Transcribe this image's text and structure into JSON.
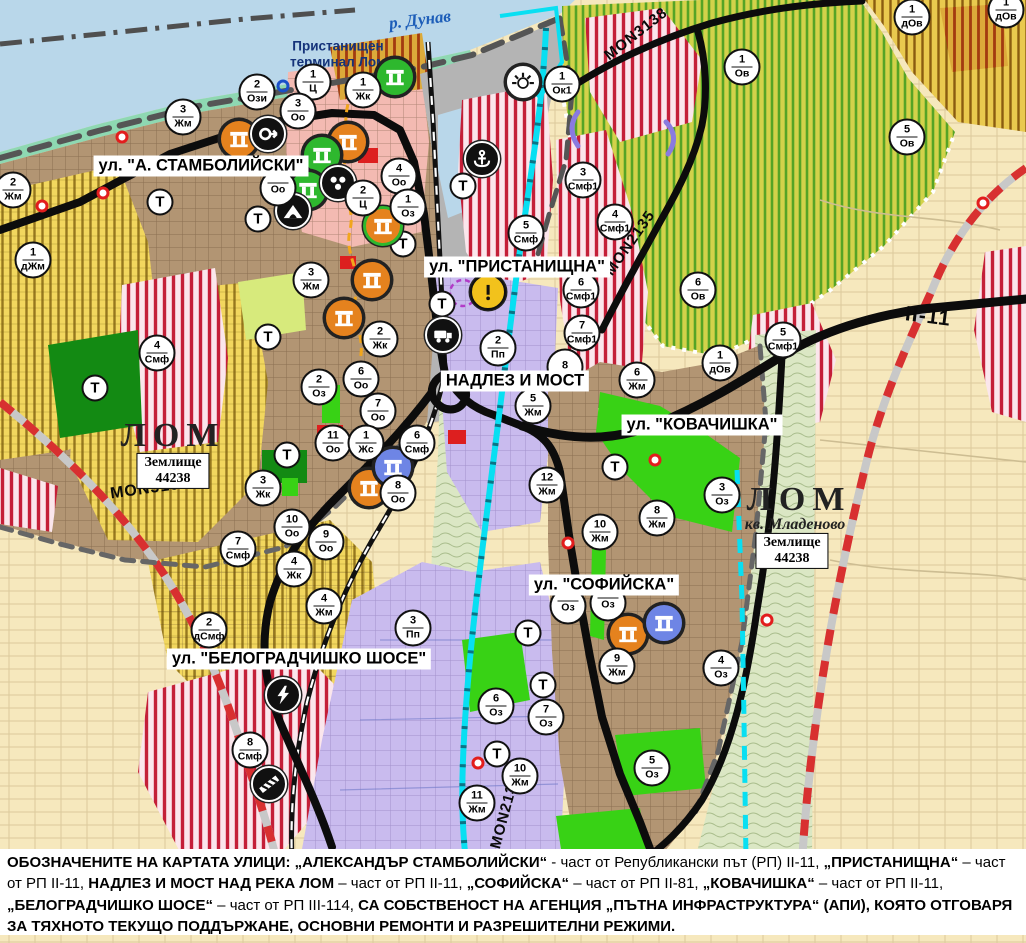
{
  "river": {
    "label": "р. Дунав",
    "x": 420,
    "y": 20
  },
  "port": {
    "line1": "Пристанищен",
    "line2": "терминал Лом",
    "x": 338,
    "y": 54
  },
  "places": {
    "lom_west": {
      "label": "ЛОМ",
      "x": 173,
      "y": 436
    },
    "lom_east": {
      "label": "ЛОМ",
      "x": 799,
      "y": 500
    },
    "kv_mladenovo": {
      "label": "кв. Младеново",
      "x": 795,
      "y": 525
    },
    "zem_west": {
      "line1": "Землище",
      "line2": "44238",
      "x": 173,
      "y": 471
    },
    "zem_east": {
      "line1": "Землище",
      "line2": "44238",
      "x": 792,
      "y": 551
    }
  },
  "street_labels": [
    {
      "text": "ул. \"А. СТАМБОЛИЙСКИ\"",
      "x": 201,
      "y": 166
    },
    {
      "text": "ул. \"ПРИСТАНИЩНА\"",
      "x": 517,
      "y": 267
    },
    {
      "text": "НАДЛЕЗ И МОСТ",
      "x": 515,
      "y": 381
    },
    {
      "text": "ул. \"КОВАЧИШКА\"",
      "x": 702,
      "y": 425
    },
    {
      "text": "ул. \"СОФИЙСКА\"",
      "x": 604,
      "y": 585
    },
    {
      "text": "ул. \"БЕЛОГРАДЧИШКО ШОСЕ\"",
      "x": 299,
      "y": 659
    }
  ],
  "road_labels": [
    {
      "text": "MON3138",
      "x": 636,
      "y": 34,
      "rot": -38,
      "size": 15
    },
    {
      "text": "MON2135",
      "x": 630,
      "y": 243,
      "rot": -55,
      "size": 15
    },
    {
      "text": "MON3139",
      "x": 150,
      "y": 489,
      "rot": -8,
      "size": 16
    },
    {
      "text": "MON2136",
      "x": 505,
      "y": 812,
      "rot": -75,
      "size": 15
    },
    {
      "text": "II-11",
      "x": 928,
      "y": 317,
      "rot": 7,
      "size": 21
    }
  ],
  "zone_markers": [
    {
      "n": "2",
      "c": "Жм",
      "x": 13,
      "y": 190
    },
    {
      "n": "3",
      "c": "Жм",
      "x": 183,
      "y": 117
    },
    {
      "n": "2",
      "c": "Ози",
      "x": 257,
      "y": 92
    },
    {
      "n": "1",
      "c": "Ц",
      "x": 313,
      "y": 82
    },
    {
      "n": "1",
      "c": "Жк",
      "x": 363,
      "y": 90
    },
    {
      "n": "3",
      "c": "Оо",
      "x": 298,
      "y": 111
    },
    {
      "n": "4",
      "c": "Оо",
      "x": 399,
      "y": 176
    },
    {
      "n": "2",
      "c": "Ц",
      "x": 363,
      "y": 198
    },
    {
      "n": "1",
      "c": "Оз",
      "x": 408,
      "y": 207
    },
    {
      "n": "",
      "c": "Оо",
      "x": 278,
      "y": 188
    },
    {
      "n": "1",
      "c": "дЖм",
      "x": 33,
      "y": 260
    },
    {
      "n": "3",
      "c": "Жм",
      "x": 311,
      "y": 280
    },
    {
      "n": "2",
      "c": "Жк",
      "x": 380,
      "y": 339
    },
    {
      "n": "2",
      "c": "Оз",
      "x": 319,
      "y": 387
    },
    {
      "n": "6",
      "c": "Оо",
      "x": 361,
      "y": 379
    },
    {
      "n": "7",
      "c": "Оо",
      "x": 378,
      "y": 411
    },
    {
      "n": "11",
      "c": "Оо",
      "x": 333,
      "y": 443
    },
    {
      "n": "1",
      "c": "Жс",
      "x": 366,
      "y": 443
    },
    {
      "n": "6",
      "c": "Смф",
      "x": 417,
      "y": 443
    },
    {
      "n": "8",
      "c": "Оо",
      "x": 398,
      "y": 493
    },
    {
      "n": "3",
      "c": "Жк",
      "x": 263,
      "y": 488
    },
    {
      "n": "10",
      "c": "Оо",
      "x": 292,
      "y": 527
    },
    {
      "n": "9",
      "c": "Оо",
      "x": 326,
      "y": 542
    },
    {
      "n": "7",
      "c": "Смф",
      "x": 238,
      "y": 549
    },
    {
      "n": "4",
      "c": "Жк",
      "x": 294,
      "y": 569
    },
    {
      "n": "4",
      "c": "Жм",
      "x": 324,
      "y": 606
    },
    {
      "n": "2",
      "c": "дСмф",
      "x": 209,
      "y": 630
    },
    {
      "n": "4",
      "c": "Смф",
      "x": 157,
      "y": 353
    },
    {
      "n": "8",
      "c": "Смф",
      "x": 250,
      "y": 750
    },
    {
      "n": "3",
      "c": "Пп",
      "x": 413,
      "y": 628
    },
    {
      "n": "2",
      "c": "Пп",
      "x": 498,
      "y": 348
    },
    {
      "n": "5",
      "c": "Смф",
      "x": 526,
      "y": 233
    },
    {
      "n": "3",
      "c": "Смф1",
      "x": 583,
      "y": 180
    },
    {
      "n": "4",
      "c": "Смф1",
      "x": 615,
      "y": 222
    },
    {
      "n": "6",
      "c": "Смф1",
      "x": 581,
      "y": 290
    },
    {
      "n": "7",
      "c": "Смф1",
      "x": 582,
      "y": 333
    },
    {
      "n": "8",
      "c": "",
      "x": 565,
      "y": 367
    },
    {
      "n": "5",
      "c": "Жм",
      "x": 533,
      "y": 406
    },
    {
      "n": "6",
      "c": "Жм",
      "x": 637,
      "y": 380
    },
    {
      "n": "12",
      "c": "Жм",
      "x": 547,
      "y": 485
    },
    {
      "n": "8",
      "c": "Жм",
      "x": 657,
      "y": 518
    },
    {
      "n": "10",
      "c": "Жм",
      "x": 600,
      "y": 532
    },
    {
      "n": "3",
      "c": "Оз",
      "x": 722,
      "y": 495
    },
    {
      "n": "9",
      "c": "Жм",
      "x": 617,
      "y": 666
    },
    {
      "n": "4",
      "c": "Оз",
      "x": 721,
      "y": 668
    },
    {
      "n": "6",
      "c": "Оз",
      "x": 496,
      "y": 706
    },
    {
      "n": "7",
      "c": "Оз",
      "x": 546,
      "y": 717
    },
    {
      "n": "10",
      "c": "Жм",
      "x": 520,
      "y": 776
    },
    {
      "n": "11",
      "c": "Жм",
      "x": 477,
      "y": 803
    },
    {
      "n": "5",
      "c": "Оз",
      "x": 652,
      "y": 768
    },
    {
      "n": "",
      "c": "Оз",
      "x": 568,
      "y": 606
    },
    {
      "n": "",
      "c": "Оз",
      "x": 608,
      "y": 603
    },
    {
      "n": "1",
      "c": "Ок1",
      "x": 562,
      "y": 84
    },
    {
      "n": "1",
      "c": "Ов",
      "x": 742,
      "y": 67
    },
    {
      "n": "5",
      "c": "Ов",
      "x": 907,
      "y": 137
    },
    {
      "n": "6",
      "c": "Ов",
      "x": 698,
      "y": 290
    },
    {
      "n": "1",
      "c": "дОв",
      "x": 720,
      "y": 363
    },
    {
      "n": "5",
      "c": "Смф1",
      "x": 783,
      "y": 340
    },
    {
      "n": "1",
      "c": "дОв",
      "x": 912,
      "y": 17
    },
    {
      "n": "1",
      "c": "дОв",
      "x": 1006,
      "y": 10
    }
  ],
  "t_markers": [
    {
      "x": 160,
      "y": 202
    },
    {
      "x": 258,
      "y": 219
    },
    {
      "x": 403,
      "y": 244
    },
    {
      "x": 442,
      "y": 304
    },
    {
      "x": 268,
      "y": 337
    },
    {
      "x": 95,
      "y": 388
    },
    {
      "x": 287,
      "y": 455
    },
    {
      "x": 615,
      "y": 467
    },
    {
      "x": 528,
      "y": 633
    },
    {
      "x": 543,
      "y": 685
    },
    {
      "x": 497,
      "y": 754
    },
    {
      "x": 463,
      "y": 186
    }
  ],
  "icon_markers": [
    {
      "type": "monument",
      "fill": "#e5821e",
      "ring": "#222",
      "x": 239,
      "y": 139
    },
    {
      "type": "monument",
      "fill": "#e5821e",
      "ring": "#222",
      "x": 348,
      "y": 142
    },
    {
      "type": "monument",
      "fill": "#e5821e",
      "ring": "#222",
      "x": 372,
      "y": 280
    },
    {
      "type": "monument",
      "fill": "#e5821e",
      "ring": "#222",
      "x": 344,
      "y": 318
    },
    {
      "type": "monument",
      "fill": "#e5821e",
      "ring": "#222",
      "x": 369,
      "y": 488
    },
    {
      "type": "monument",
      "fill": "#e5821e",
      "ring": "#222",
      "x": 628,
      "y": 634
    },
    {
      "type": "monument",
      "fill": "#e5821e",
      "ring": "#2eb82e",
      "x": 383,
      "y": 226
    },
    {
      "type": "monument",
      "fill": "#2eb82e",
      "ring": "#222",
      "x": 395,
      "y": 77
    },
    {
      "type": "monument",
      "fill": "#2eb82e",
      "ring": "#222",
      "x": 322,
      "y": 155
    },
    {
      "type": "monument",
      "fill": "#2eb82e",
      "ring": "#222",
      "x": 308,
      "y": 190
    },
    {
      "type": "monument",
      "fill": "#6e85e5",
      "ring": "#222",
      "x": 393,
      "y": 467
    },
    {
      "type": "monument",
      "fill": "#6e85e5",
      "ring": "#222",
      "x": 664,
      "y": 623
    },
    {
      "type": "circle-arrow",
      "fill": "#111",
      "ring": "#fff",
      "x": 268,
      "y": 134
    },
    {
      "type": "group",
      "fill": "#111",
      "ring": "#fff",
      "x": 338,
      "y": 183
    },
    {
      "type": "cave",
      "fill": "#111",
      "ring": "#fff",
      "x": 293,
      "y": 211
    },
    {
      "type": "truck",
      "fill": "#111",
      "ring": "#fff",
      "x": 443,
      "y": 335
    },
    {
      "type": "anchor",
      "fill": "#111",
      "ring": "#fff",
      "x": 482,
      "y": 159
    },
    {
      "type": "lightning",
      "fill": "#111",
      "ring": "#fff",
      "x": 283,
      "y": 695
    },
    {
      "type": "barrier",
      "fill": "#111",
      "ring": "#fff",
      "x": 269,
      "y": 784
    },
    {
      "type": "sun",
      "fill": "#fff",
      "ring": "#222",
      "x": 523,
      "y": 82
    },
    {
      "type": "warning",
      "fill": "#f2c21c",
      "ring": "#111",
      "x": 488,
      "y": 292
    }
  ],
  "small_markers": [
    {
      "kind": "blue-ring",
      "x": 283,
      "y": 86
    },
    {
      "kind": "red-dot",
      "x": 122,
      "y": 137
    },
    {
      "kind": "red-dot",
      "x": 103,
      "y": 193
    },
    {
      "kind": "red-dot",
      "x": 42,
      "y": 206
    },
    {
      "kind": "red-dot",
      "x": 655,
      "y": 460
    },
    {
      "kind": "red-dot",
      "x": 568,
      "y": 543
    },
    {
      "kind": "red-dot",
      "x": 983,
      "y": 203
    },
    {
      "kind": "red-dot",
      "x": 478,
      "y": 763
    },
    {
      "kind": "red-dot",
      "x": 767,
      "y": 620
    }
  ],
  "note": {
    "segments": [
      {
        "b": 1,
        "t": "ОБОЗНАЧЕНИТЕ НА КАРТАТА УЛИЦИ: „АЛЕКСАНДЪР СТАМБОЛИЙСКИ“"
      },
      {
        "b": 0,
        "t": " - част от Републикански път (РП) II-11, "
      },
      {
        "b": 1,
        "t": "„ПРИСТАНИЩНА“"
      },
      {
        "b": 0,
        "t": " – част от РП II-11, "
      },
      {
        "b": 1,
        "t": "НАДЛЕЗ И МОСТ НАД РЕКА ЛОМ"
      },
      {
        "b": 0,
        "t": " – част от РП II-11, "
      },
      {
        "b": 1,
        "t": "„СОФИЙСКА“"
      },
      {
        "b": 0,
        "t": " – част от РП II-81, "
      },
      {
        "b": 1,
        "t": "„КОВАЧИШКА“"
      },
      {
        "b": 0,
        "t": " – част от РП II-11, "
      },
      {
        "b": 1,
        "t": "„БЕЛОГРАДЧИШКО ШОСЕ“"
      },
      {
        "b": 0,
        "t": " – част от РП III-114, "
      },
      {
        "b": 1,
        "t": "СА СОБСТВЕНОСТ НА АГЕНЦИЯ „ПЪТНА ИНФРАСТРУКТУРА“ (АПИ), КОЯТО ОТГОВАРЯ ЗА ТЯХНОТО ТЕКУЩО ПОДДЪРЖАНЕ, ОСНОВНИ РЕМОНТИ И РАЗРЕШИТЕЛНИ РЕЖИМИ."
      }
    ]
  }
}
